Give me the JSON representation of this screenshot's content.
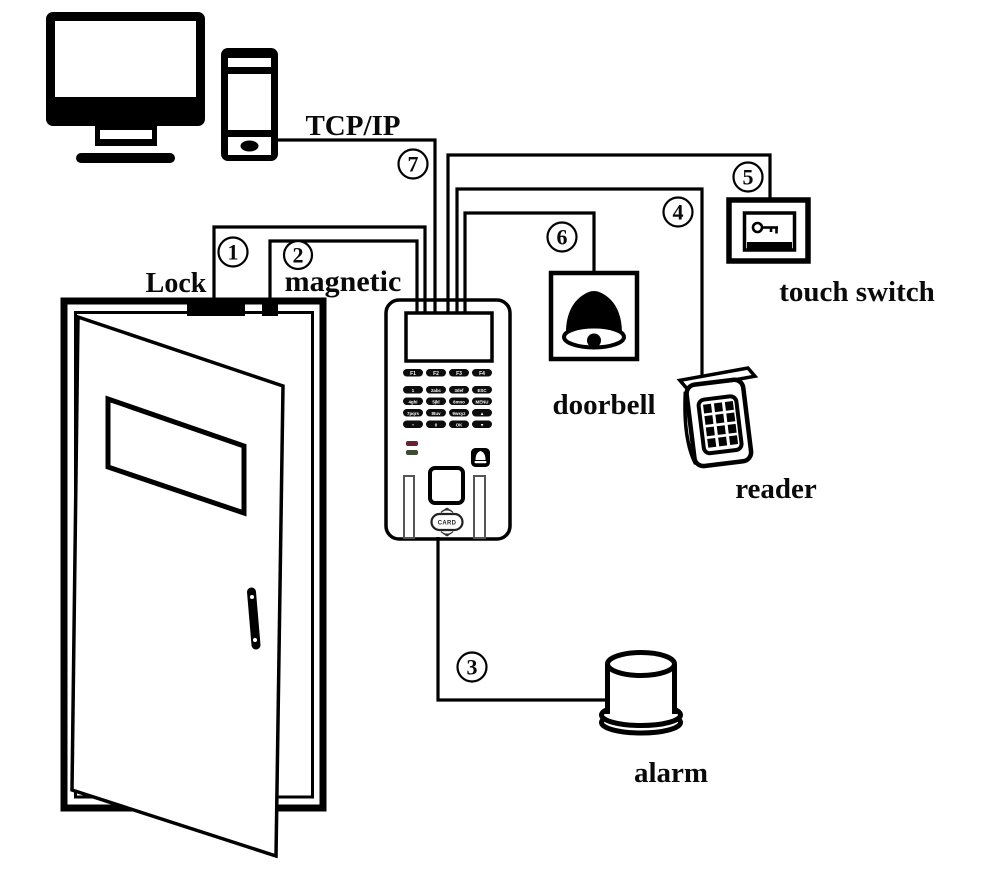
{
  "labels": {
    "protocol": "TCP/IP",
    "lock": "Lock",
    "magnetic": "magnetic",
    "doorbell": "doorbell",
    "touch_switch": "touch switch",
    "reader": "reader",
    "alarm": "alarm"
  },
  "connection_numbers": {
    "lock": "1",
    "magnetic": "2",
    "alarm": "3",
    "reader": "4",
    "touch_switch": "5",
    "doorbell": "6",
    "tcp_ip": "7"
  },
  "device": {
    "function_keys": [
      "F1",
      "F2",
      "F3",
      "F4"
    ],
    "keypad_rows": {
      "r1": [
        "1",
        "2abc",
        "3def",
        "ESC"
      ],
      "r2": [
        "4ghi",
        "5jkl",
        "6mno",
        "MENU"
      ],
      "r3": [
        "7pqrs",
        "8tuv",
        "9wxyz",
        "▲"
      ],
      "r4": [
        "•",
        "0",
        "OK",
        "▼"
      ]
    },
    "card_label": "CARD"
  },
  "colors": {
    "led_red": "#6e1f2e",
    "led_green": "#3c4b31",
    "ink": "#000000",
    "background": "#ffffff"
  }
}
